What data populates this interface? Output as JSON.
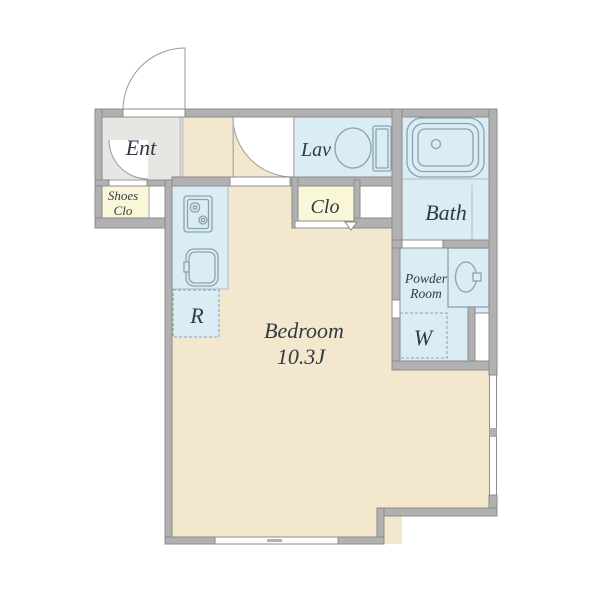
{
  "plan": {
    "rooms": {
      "ent": {
        "label": "Ent"
      },
      "shoes_closet": {
        "line1": "Shoes",
        "line2": "Clo"
      },
      "lavatory": {
        "label": "Lav"
      },
      "bath": {
        "label": "Bath"
      },
      "closet": {
        "label": "Clo"
      },
      "powder_room": {
        "line1": "Powder",
        "line2": "Room"
      },
      "washer_space": {
        "label": "W"
      },
      "refrigerator_space": {
        "label": "R"
      },
      "bedroom": {
        "label": "Bedroom",
        "size": "10.3J"
      }
    },
    "colors": {
      "wall": "#b1b1b1",
      "wall_stroke": "#8c8c8c",
      "floor_bedroom": "#f3e7cd",
      "floor_ent": "#e6e6e3",
      "floor_wet": "#daecf4",
      "floor_closet": "#faf6d8",
      "fixture_stroke": "#8ba3b0",
      "label": "#333a45",
      "thin_line": "#a9bdc7"
    }
  }
}
